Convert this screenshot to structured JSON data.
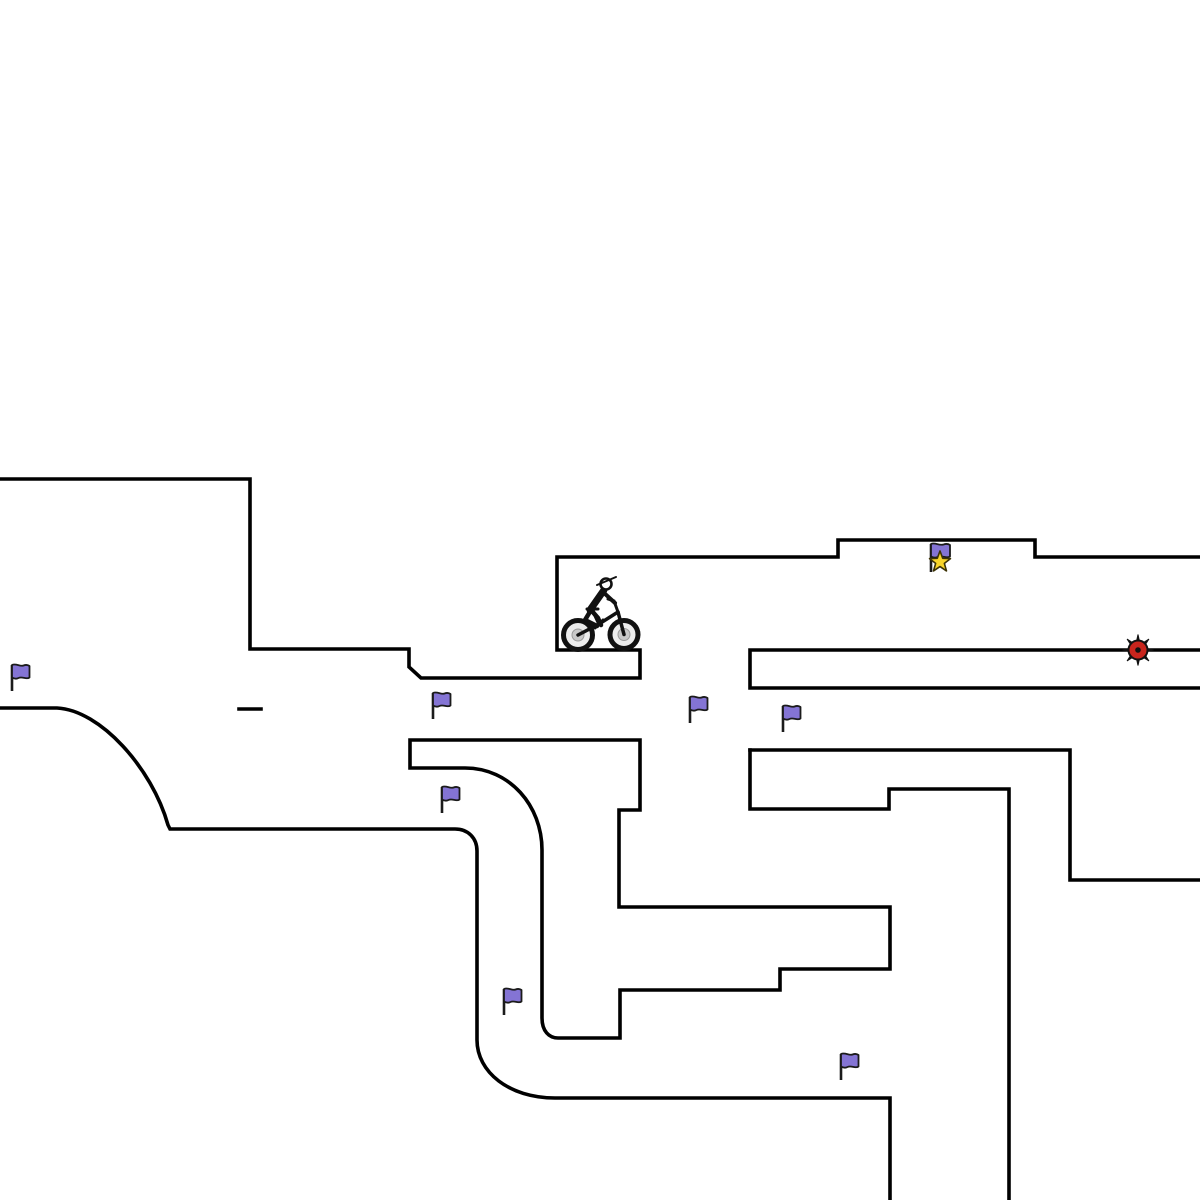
{
  "scene": {
    "name": "bike-trials-level",
    "width": 1200,
    "height": 1200,
    "background": "#ffffff"
  },
  "colors": {
    "terrain_line": "#000000",
    "flag_fill": "#8474d4",
    "flag_stroke": "#1b1b1b",
    "pole_color": "#1b1b1b",
    "star_fill": "#f8d429",
    "star_stroke": "#3d3305",
    "mine_fill": "#c8251d",
    "mine_spikes": "#111111",
    "wheel_rim": "#111111",
    "wheel_tire_fill": "#ececec",
    "wheel_hub": "#c8c8c8",
    "wheel_hub_edge": "#9a9a9a",
    "rider_color": "#111111",
    "head_fill": "#ffffff"
  },
  "terrain": {
    "stroke_width": 3.6,
    "paths": [
      {
        "name": "upper-terrain",
        "d": "M 0 479 L 250 479 L 250 649 L 409 649 L 409 667 L 421 678 L 640 678 L 640 650 L 557 650 L 557 557 L 838 557 L 838 540 L 1035 540 L 1035 557 L 1200 557"
      },
      {
        "name": "right-bar-platform",
        "d": "M 1200 650 L 750 650 L 750 688 L 1200 688"
      },
      {
        "name": "right-upper-shelf",
        "d": "M 750 750 L 1070 750 L 1070 880 L 1200 880"
      },
      {
        "name": "right-inner-wall",
        "d": "M 750 750 L 750 809 L 889 809 L 889 789 L 1009 789 L 1009 1200"
      },
      {
        "name": "left-swoop-ramp",
        "d": "M 0 708 L 57 708 C 100 710 152 768 168 825 L 170 829 L 455 829 C 468 829 477 838 477 851 L 477 1040 C 477 1072 509 1098 555 1098 L 890 1098 L 890 1200"
      },
      {
        "name": "island-polygon",
        "d": "M 410 740 L 640 740 L 640 810 L 619 810 L 619 907 L 890 907 L 890 969 L 780 969 L 780 990 L 620 990 L 620 1038 L 558 1038 C 549 1038 542 1031 542 1018 L 542 850 C 542 806 510 768 465 768 L 410 768 Z"
      },
      {
        "name": "dash-platform",
        "d": "M 239 709 L 261 709"
      }
    ]
  },
  "entities": {
    "checkpoint_flags": [
      {
        "x": 12,
        "y": 665
      },
      {
        "x": 433,
        "y": 693
      },
      {
        "x": 690,
        "y": 697
      },
      {
        "x": 783,
        "y": 706
      },
      {
        "x": 442,
        "y": 787
      },
      {
        "x": 504,
        "y": 989
      },
      {
        "x": 841,
        "y": 1054
      }
    ],
    "flag_style": {
      "pole_height": 26,
      "cloth_width": 17.5,
      "cloth_height": 13
    },
    "goal_flag": {
      "x": 931,
      "y": 544,
      "pole_height": 28,
      "star_cx": 940,
      "star_cy": 562,
      "star_outer_r": 11,
      "star_inner_r": 4.6
    },
    "mine": {
      "x": 1138,
      "y": 650,
      "spike_r": 15.5,
      "body_r": 9.5,
      "core_r": 2.8
    },
    "rider": {
      "x": 578,
      "y": 635
    }
  }
}
